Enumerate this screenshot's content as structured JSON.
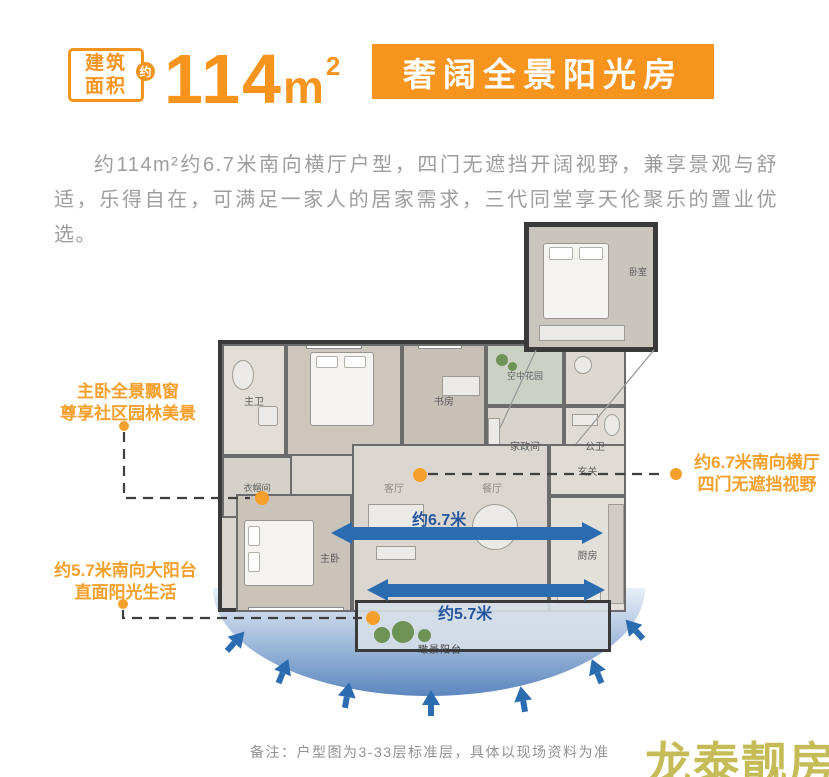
{
  "header": {
    "badge_line1": "建筑",
    "badge_line2": "面积",
    "badge_circle": "约",
    "area_value": "114",
    "area_unit": "m",
    "area_sup": "2",
    "title": "奢阔全景阳光房"
  },
  "intro": "约114m²约6.7米南向横厅户型，四门无遮挡开阔视野，兼享景观与舒适，乐得自在，可满足一家人的居家需求，三代同堂享天伦聚乐的置业优选。",
  "callouts": {
    "left_top": {
      "line1": "主卧全景飘窗",
      "line2": "尊享社区园林美景"
    },
    "left_bottom": {
      "line1": "约5.7米南向大阳台",
      "line2": "直面阳光生活"
    },
    "right": {
      "line1": "约6.7米南向横厅",
      "line2": "四门无遮挡视野"
    }
  },
  "floorplan": {
    "rooms": {
      "master_bath": "主卫",
      "bedroom": "卧室",
      "study": "书房",
      "sky_garden": "空中花园",
      "utility": "家政间",
      "guest_bath": "公卫",
      "cloakroom": "衣帽间",
      "master_bedroom": "主卧",
      "living": "客厅",
      "dining": "餐厅",
      "foyer": "玄关",
      "kitchen": "厨房",
      "balcony": "瞰景阳台",
      "inset_bedroom": "卧室"
    },
    "dimensions": {
      "living_width": "约6.7米",
      "balcony_width": "约5.7米"
    }
  },
  "note": "备注：户型图为3-33层标准层，具体以现场资料为准",
  "watermark": "龙泰靓房",
  "colors": {
    "accent_orange": "#F7941E",
    "arrow_blue": "#2B6CB0",
    "watermark_olive": "#C5BC58"
  }
}
